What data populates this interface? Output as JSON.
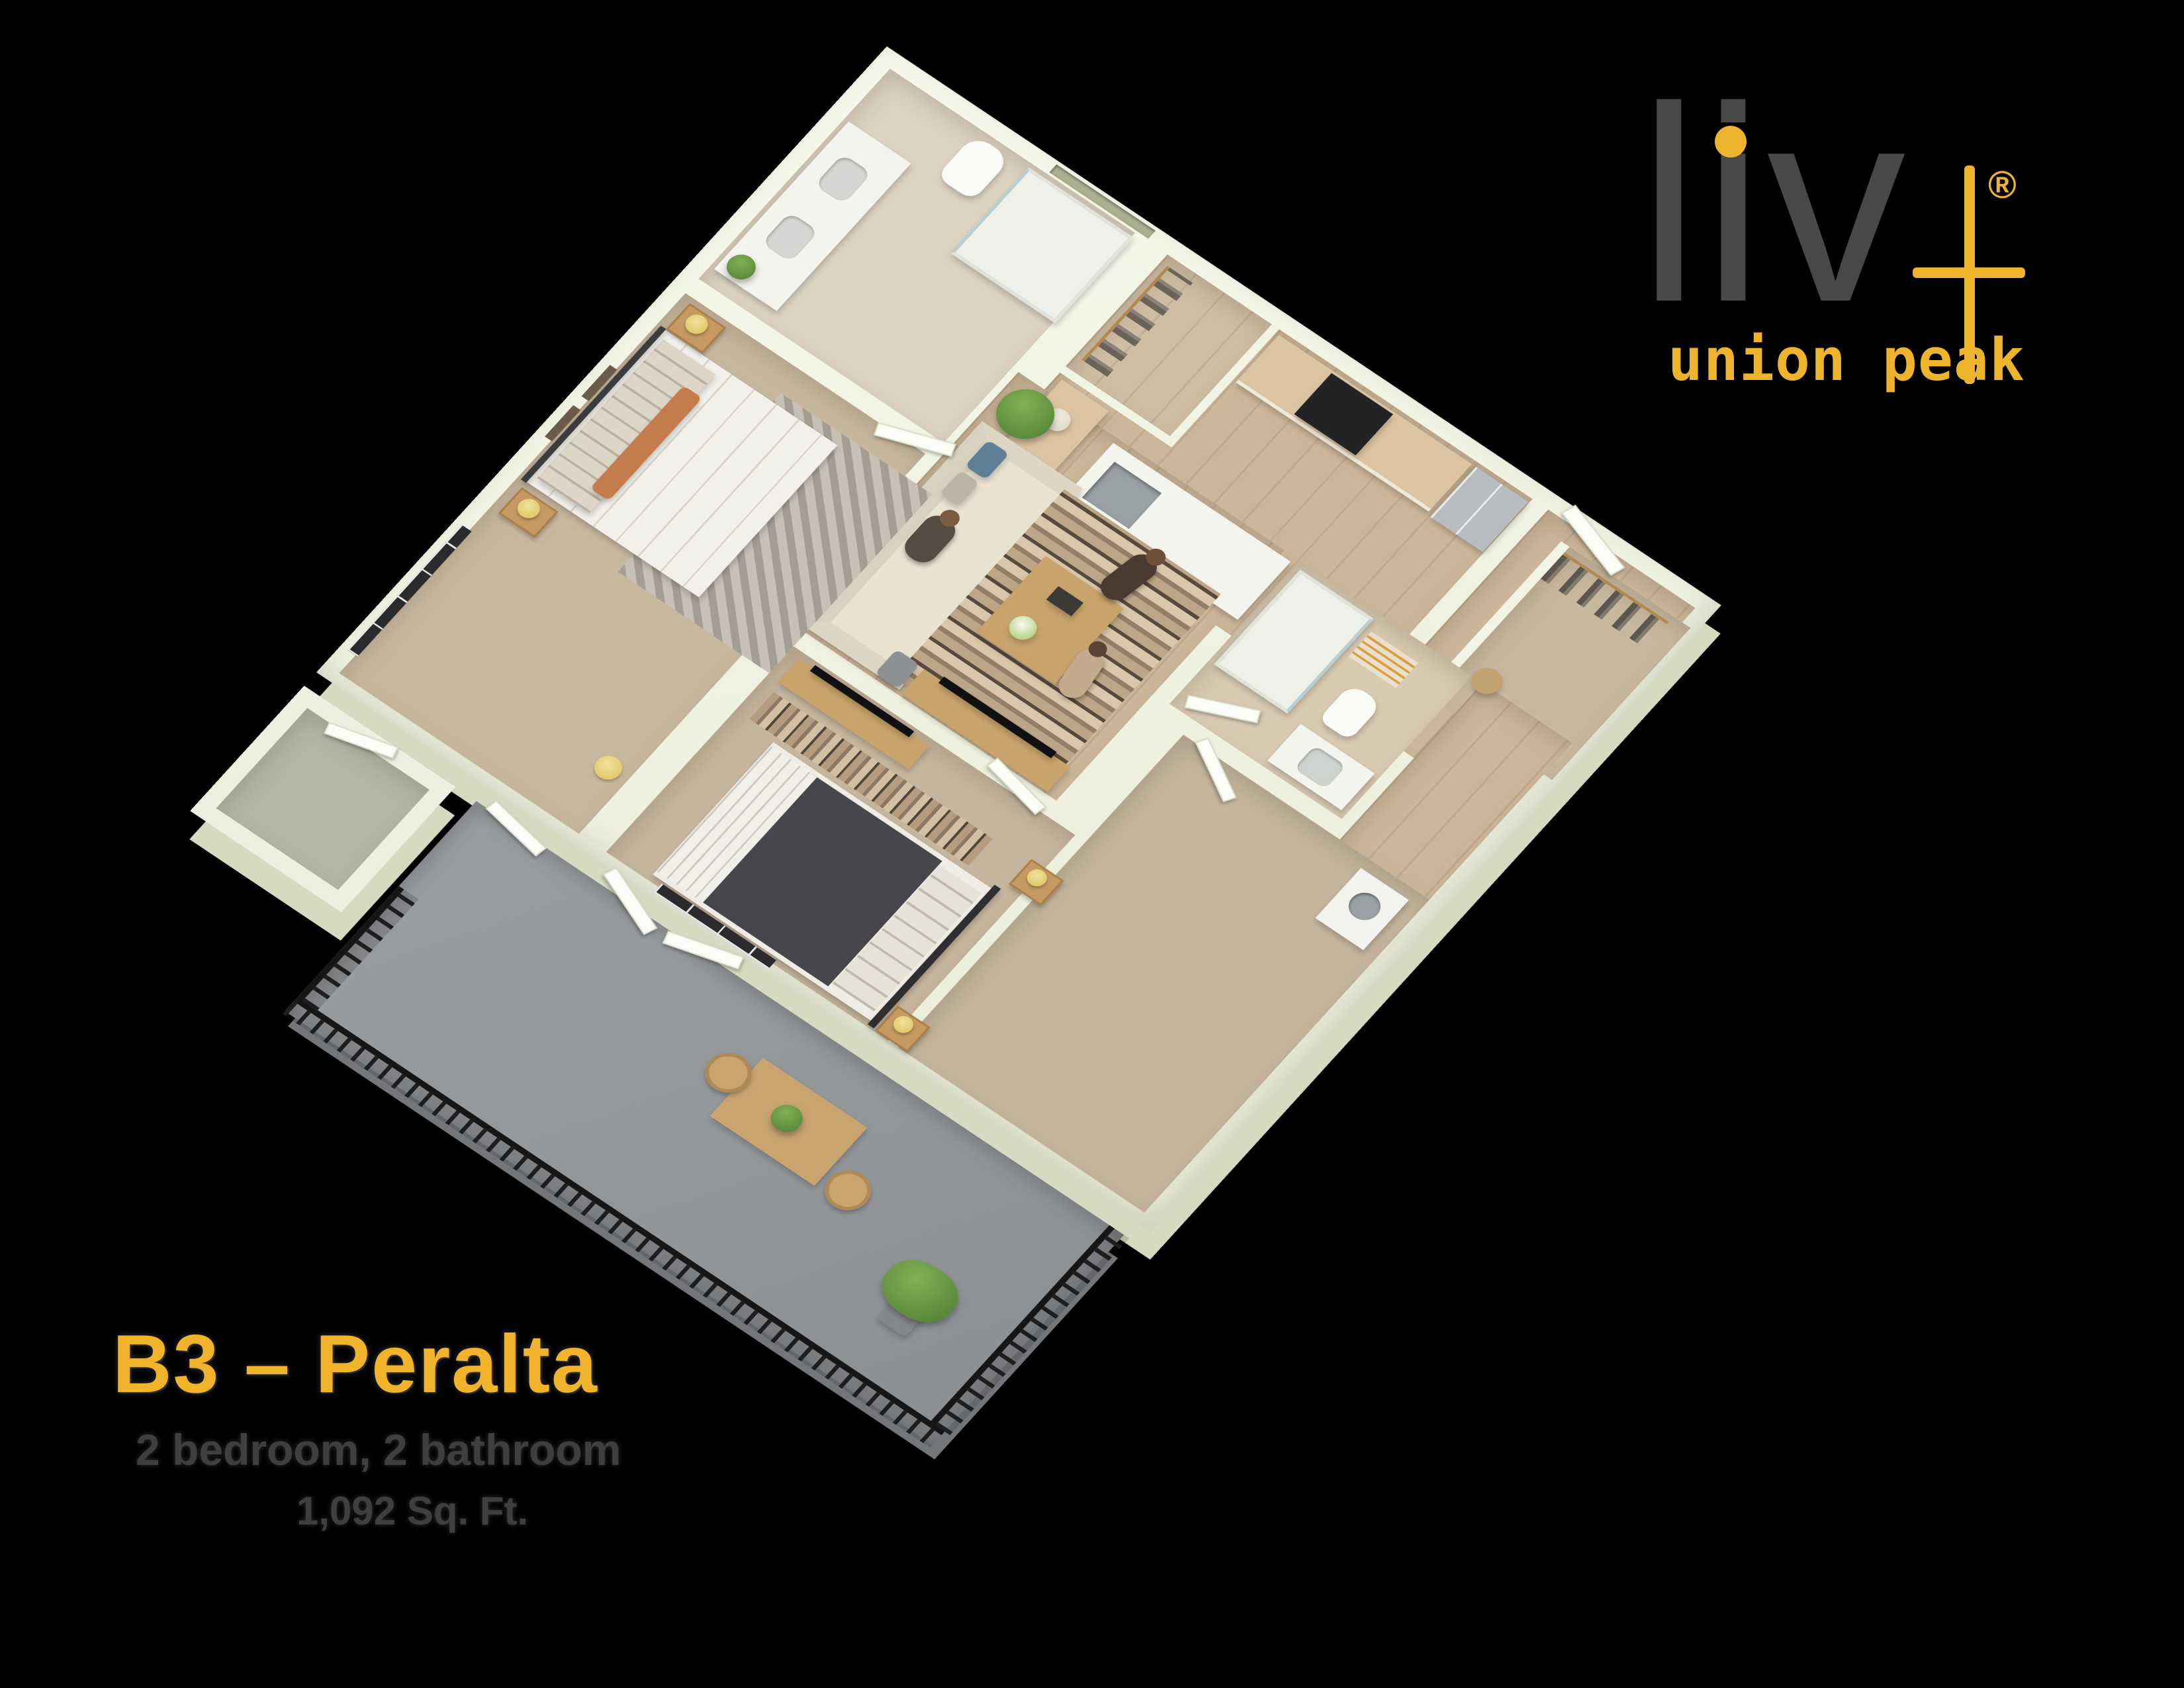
{
  "branding": {
    "logo_word": "liv",
    "logo_plus_icon": "plus-icon",
    "logo_registered": "®",
    "tagline": "union peak",
    "accent_color": "#eeb32d",
    "logo_text_color": "#48484a"
  },
  "plan_info": {
    "title": "B3 – Peralta",
    "details": "2 bedroom, 2 bathroom",
    "area": "1,092 Sq. Ft.",
    "title_color": "#f1b22c",
    "details_color": "#3f3e41"
  },
  "scene": {
    "background_color": "#000000",
    "wall_color": "#f2f4e3",
    "wood_floor_color": "#ccb69a",
    "carpet_color": "#c8b79f",
    "tile_floor_color": "#dcd2c0",
    "balcony_floor_color": "#96999c",
    "railing_color": "#1e1e1e",
    "cabinet_wood_color": "#dbc4a2",
    "appliance_color": "#b9bcbf"
  }
}
